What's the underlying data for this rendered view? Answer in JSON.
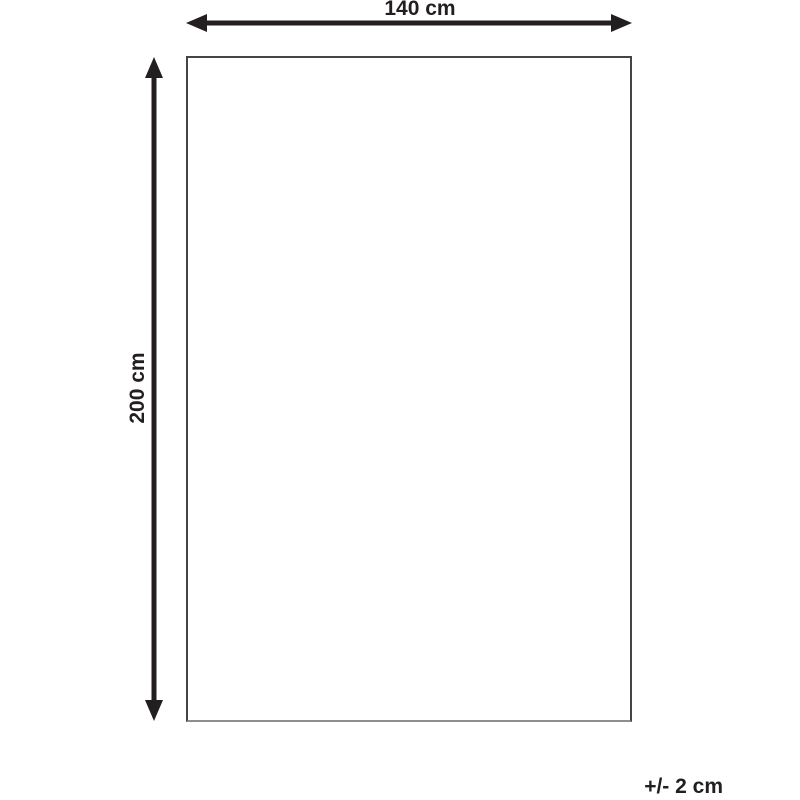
{
  "labels": {
    "width": "140 cm",
    "height": "200 cm",
    "tolerance": "+/- 2 cm"
  },
  "colors": {
    "arrow": "#231f20",
    "text": "#231f20",
    "rect_border": "#454547",
    "rect_border_bottom": "#8e8e90",
    "background": "#ffffff"
  }
}
